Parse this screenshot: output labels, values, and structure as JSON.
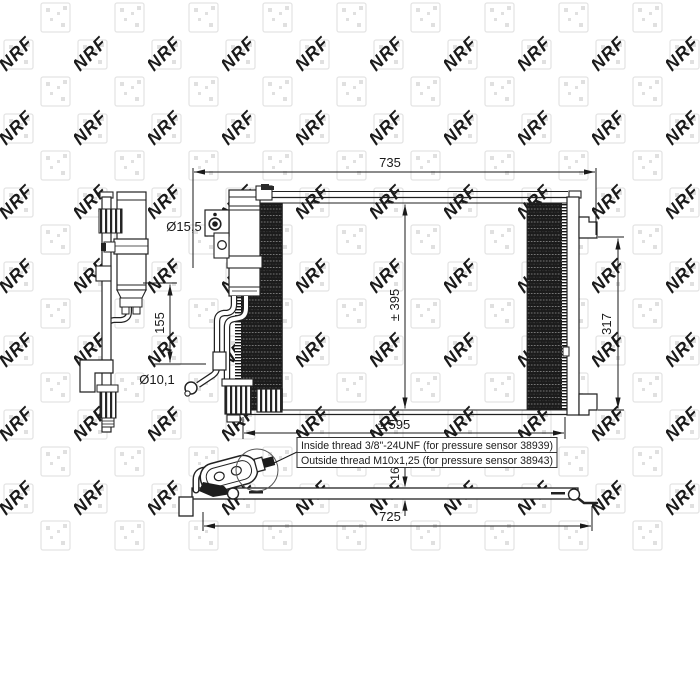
{
  "watermark": {
    "brand": "NRF"
  },
  "dimensions": {
    "total_width": "735",
    "core_height": "± 395",
    "right_bracket_height": "317",
    "core_width": "± 595",
    "drier_pipe_offset": "155",
    "port_large_diameter": "Ø15,5",
    "port_small_diameter": "Ø10,1",
    "depth": "16",
    "bottom_width": "725"
  },
  "notes": {
    "inside_thread": "Inside thread 3/8\"-24UNF (for pressure sensor 38939)",
    "outside_thread": "Outside thread M10x1,25 (for pressure sensor 38943)"
  }
}
